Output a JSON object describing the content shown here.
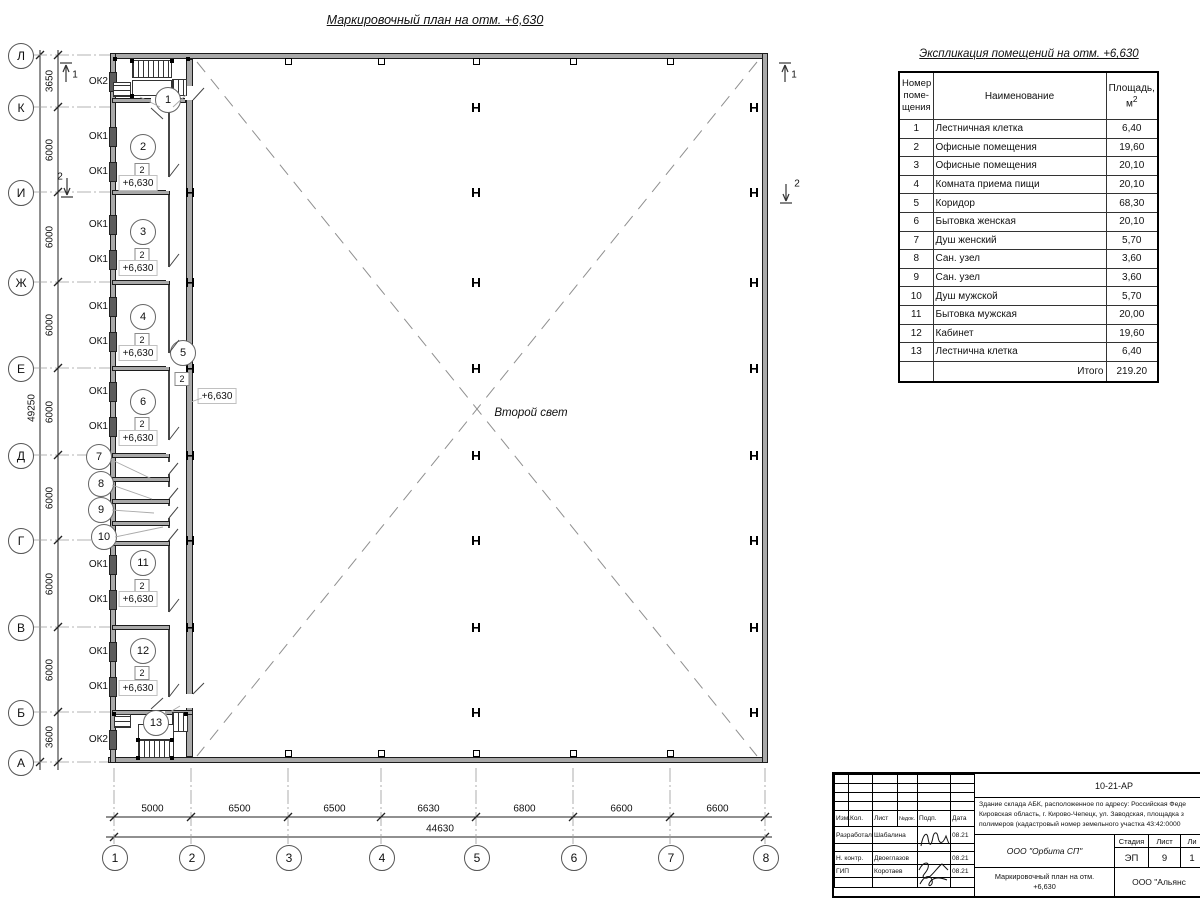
{
  "drawing": {
    "title": "Маркировочный план на отм. +6,630",
    "hall_label": "Второй свет"
  },
  "plan": {
    "rows": [
      {
        "label": "Л",
        "y": 55
      },
      {
        "label": "К",
        "y": 107
      },
      {
        "label": "И",
        "y": 192
      },
      {
        "label": "Ж",
        "y": 282
      },
      {
        "label": "Е",
        "y": 368
      },
      {
        "label": "Д",
        "y": 455
      },
      {
        "label": "Г",
        "y": 540
      },
      {
        "label": "В",
        "y": 627
      },
      {
        "label": "Б",
        "y": 712
      },
      {
        "label": "А",
        "y": 762
      }
    ],
    "cols": [
      {
        "label": "1",
        "x": 114
      },
      {
        "label": "2",
        "x": 191
      },
      {
        "label": "3",
        "x": 288
      },
      {
        "label": "4",
        "x": 381
      },
      {
        "label": "5",
        "x": 476
      },
      {
        "label": "6",
        "x": 573
      },
      {
        "label": "7",
        "x": 670
      },
      {
        "label": "8",
        "x": 765
      }
    ],
    "row_dims": [
      "3650",
      "6000",
      "6000",
      "6000",
      "6000",
      "6000",
      "6000",
      "6000",
      "3600"
    ],
    "row_total": "49250",
    "col_dims": [
      "5000",
      "6500",
      "6500",
      "6630",
      "6800",
      "6600",
      "6600"
    ],
    "col_total": "44630",
    "windows": [
      {
        "label": "ОК2",
        "y": 82
      },
      {
        "label": "ОК1",
        "y": 137
      },
      {
        "label": "ОК1",
        "y": 172
      },
      {
        "label": "ОК1",
        "y": 225
      },
      {
        "label": "ОК1",
        "y": 260
      },
      {
        "label": "ОК1",
        "y": 307
      },
      {
        "label": "ОК1",
        "y": 342
      },
      {
        "label": "ОК1",
        "y": 392
      },
      {
        "label": "ОК1",
        "y": 427
      },
      {
        "label": "ОК1",
        "y": 565
      },
      {
        "label": "ОК1",
        "y": 600
      },
      {
        "label": "ОК1",
        "y": 652
      },
      {
        "label": "ОК1",
        "y": 687
      },
      {
        "label": "ОК2",
        "y": 740
      }
    ],
    "interior_walls": [
      {
        "y": 100,
        "x1": 112,
        "x2": 186
      },
      {
        "y": 192,
        "x1": 112,
        "x2": 170
      },
      {
        "y": 282,
        "x1": 112,
        "x2": 170
      },
      {
        "y": 368,
        "x1": 112,
        "x2": 170
      },
      {
        "y": 455,
        "x1": 112,
        "x2": 170
      },
      {
        "y": 479,
        "x1": 112,
        "x2": 170
      },
      {
        "y": 501,
        "x1": 112,
        "x2": 170
      },
      {
        "y": 523,
        "x1": 112,
        "x2": 170
      },
      {
        "y": 543,
        "x1": 112,
        "x2": 170
      },
      {
        "y": 627,
        "x1": 112,
        "x2": 170
      },
      {
        "y": 712,
        "x1": 112,
        "x2": 193
      }
    ],
    "rooms": [
      {
        "num": "1",
        "cx": 167,
        "cy": 99
      },
      {
        "num": "2",
        "cx": 142,
        "cy": 146,
        "mark": "2",
        "my": 170,
        "elev": "+6,630",
        "ey": 183
      },
      {
        "num": "3",
        "cx": 142,
        "cy": 231,
        "mark": "2",
        "my": 255,
        "elev": "+6,630",
        "ey": 268
      },
      {
        "num": "4",
        "cx": 142,
        "cy": 316,
        "mark": "2",
        "my": 340,
        "elev": "+6,630",
        "ey": 353
      },
      {
        "num": "5",
        "cx": 182,
        "cy": 352,
        "mark": "2",
        "mx": 182,
        "my": 379,
        "elev": "+6,630",
        "ex": 217,
        "ey": 396
      },
      {
        "num": "6",
        "cx": 142,
        "cy": 401,
        "mark": "2",
        "my": 424,
        "elev": "+6,630",
        "ey": 438
      },
      {
        "num": "7",
        "cx": 98,
        "cy": 456
      },
      {
        "num": "8",
        "cx": 100,
        "cy": 483
      },
      {
        "num": "9",
        "cx": 100,
        "cy": 509
      },
      {
        "num": "10",
        "cx": 103,
        "cy": 536
      },
      {
        "num": "11",
        "cx": 142,
        "cy": 562,
        "mark": "2",
        "my": 586,
        "elev": "+6,630",
        "ey": 599
      },
      {
        "num": "12",
        "cx": 142,
        "cy": 650,
        "mark": "2",
        "my": 673,
        "elev": "+6,630",
        "ey": 688
      },
      {
        "num": "13",
        "cx": 155,
        "cy": 722
      }
    ],
    "h_columns": {
      "free_xs": [
        476,
        754
      ],
      "free_ys": [
        107,
        192,
        282,
        368,
        455,
        540,
        627,
        712
      ],
      "wall_x": 190,
      "wall_ys": [
        192,
        282,
        368,
        455,
        540,
        627
      ]
    },
    "top_squares": [
      288,
      381,
      476,
      573,
      670
    ],
    "bottom_squares": [
      288,
      381,
      476,
      573,
      670
    ],
    "section_marks": [
      {
        "label": "1",
        "x": 75,
        "y": 75
      },
      {
        "label": "2",
        "x": 60,
        "y": 177
      },
      {
        "label": "1",
        "x": 794,
        "y": 75
      },
      {
        "label": "2",
        "x": 797,
        "y": 184
      }
    ],
    "doors": [
      {
        "r": [
          166,
          177,
          5,
          14
        ],
        "l": [
          169,
          177,
          179,
          164
        ]
      },
      {
        "r": [
          166,
          267,
          5,
          14
        ],
        "l": [
          169,
          267,
          179,
          254
        ]
      },
      {
        "r": [
          166,
          353,
          5,
          14
        ],
        "l": [
          169,
          353,
          179,
          340
        ]
      },
      {
        "r": [
          166,
          440,
          5,
          14
        ],
        "l": [
          169,
          440,
          179,
          427
        ]
      },
      {
        "r": [
          166,
          462,
          5,
          12
        ],
        "l": [
          169,
          474,
          178,
          463
        ]
      },
      {
        "r": [
          166,
          487,
          5,
          12
        ],
        "l": [
          169,
          499,
          178,
          488
        ]
      },
      {
        "r": [
          166,
          506,
          5,
          12
        ],
        "l": [
          169,
          518,
          178,
          507
        ]
      },
      {
        "r": [
          166,
          528,
          5,
          12
        ],
        "l": [
          169,
          540,
          178,
          529
        ]
      },
      {
        "r": [
          166,
          612,
          5,
          13
        ],
        "l": [
          169,
          612,
          179,
          599
        ]
      },
      {
        "r": [
          166,
          697,
          5,
          13
        ],
        "l": [
          169,
          697,
          179,
          684
        ]
      },
      {
        "r": [
          185,
          86,
          9,
          14
        ],
        "l": [
          193,
          100,
          204,
          88
        ]
      },
      {
        "r": [
          185,
          694,
          9,
          14
        ],
        "l": [
          193,
          694,
          204,
          683
        ]
      },
      {
        "r": [
          151,
          98,
          14,
          7
        ],
        "l": [
          151,
          108,
          163,
          119
        ]
      },
      {
        "r": [
          151,
          711,
          14,
          7
        ],
        "l": [
          151,
          709,
          163,
          698
        ]
      }
    ],
    "leaders": [
      [
        160,
        107,
        140,
        97
      ],
      [
        173,
        107,
        186,
        95
      ],
      [
        202,
        398,
        188,
        403
      ],
      [
        110,
        459,
        152,
        479
      ],
      [
        112,
        485,
        152,
        499
      ],
      [
        112,
        510,
        154,
        513
      ],
      [
        115,
        537,
        163,
        527
      ],
      [
        165,
        715,
        180,
        706
      ]
    ],
    "stairs": {
      "treads": [
        {
          "x": 132,
          "y": 60,
          "w": 40,
          "h": 18,
          "dir": "v"
        },
        {
          "x": 113,
          "y": 82,
          "w": 18,
          "h": 15,
          "dir": "h"
        },
        {
          "x": 172,
          "y": 79,
          "w": 15,
          "h": 17,
          "dir": "v"
        },
        {
          "x": 138,
          "y": 740,
          "w": 36,
          "h": 18,
          "dir": "v"
        },
        {
          "x": 114,
          "y": 714,
          "w": 17,
          "h": 14,
          "dir": "h"
        },
        {
          "x": 172,
          "y": 712,
          "w": 16,
          "h": 20,
          "dir": "v"
        }
      ],
      "landings": [
        {
          "x": 132,
          "y": 80,
          "w": 40,
          "h": 16
        },
        {
          "x": 138,
          "y": 724,
          "w": 36,
          "h": 16
        }
      ],
      "newels": [
        [
          130,
          59
        ],
        [
          170,
          59
        ],
        [
          130,
          94
        ],
        [
          170,
          94
        ],
        [
          113,
          57
        ],
        [
          186,
          57
        ],
        [
          136,
          738
        ],
        [
          170,
          738
        ],
        [
          136,
          756
        ],
        [
          170,
          756
        ],
        [
          112,
          712
        ],
        [
          184,
          712
        ]
      ]
    }
  },
  "schedule": {
    "title": "Экспликация помещений на отм. +6,630",
    "headers": {
      "num1": "Номер",
      "num2": "поме-",
      "num3": "щения",
      "name": "Наименование",
      "area1": "Площадь,",
      "area_base": "м",
      "area_sup": "2"
    },
    "rows": [
      [
        "1",
        "Лестничная клетка",
        "6,40"
      ],
      [
        "2",
        "Офисные помещения",
        "19,60"
      ],
      [
        "3",
        "Офисные помещения",
        "20,10"
      ],
      [
        "4",
        "Комната приема пищи",
        "20,10"
      ],
      [
        "5",
        "Коридор",
        "68,30"
      ],
      [
        "6",
        "Бытовка женская",
        "20,10"
      ],
      [
        "7",
        "Душ женский",
        "5,70"
      ],
      [
        "8",
        "Сан. узел",
        "3,60"
      ],
      [
        "9",
        "Сан. узел",
        "3,60"
      ],
      [
        "10",
        "Душ мужской",
        "5,70"
      ],
      [
        "11",
        "Бытовка мужская",
        "20,00"
      ],
      [
        "12",
        "Кабинет",
        "19,60"
      ],
      [
        "13",
        "Лестнична клетка",
        "6,40"
      ]
    ],
    "total_label": "Итого",
    "total_value": "219.20"
  },
  "titleblock": {
    "code": "10-21-АР",
    "desc1": "Здание склада АБК, расположенное по адресу: Российская Феде",
    "desc2": "Кировская область, г. Кирово-Чепецк, ул. Заводская, площадка з",
    "desc3": "полимеров (кадастровый номер земельного участка 43:42:0000",
    "cols": {
      "izm": "Изм.",
      "kol": "Кол.",
      "list": "Лист",
      "ndok": "№док.",
      "podp": "Подп.",
      "data": "Дата"
    },
    "people": [
      {
        "role": "Разработал",
        "name": "Шабалина",
        "date": "08.21"
      },
      {
        "role": "",
        "name": "",
        "date": ""
      },
      {
        "role": "Н. контр.",
        "name": "Двоеглазов",
        "date": "08.21"
      },
      {
        "role": "ГИП",
        "name": "Коротаев",
        "date": "08.21"
      }
    ],
    "org": "ООО \"Орбита СП\"",
    "stage_h1": "Стадия",
    "stage_h2": "Лист",
    "stage_h3": "Ли",
    "stage_v1": "ЭП",
    "stage_v2": "9",
    "stage_v3": "1",
    "sheet_title_l1": "Маркировочный план на отм.",
    "sheet_title_l2": "+6,630",
    "org2": "ООО \"Альянс"
  }
}
